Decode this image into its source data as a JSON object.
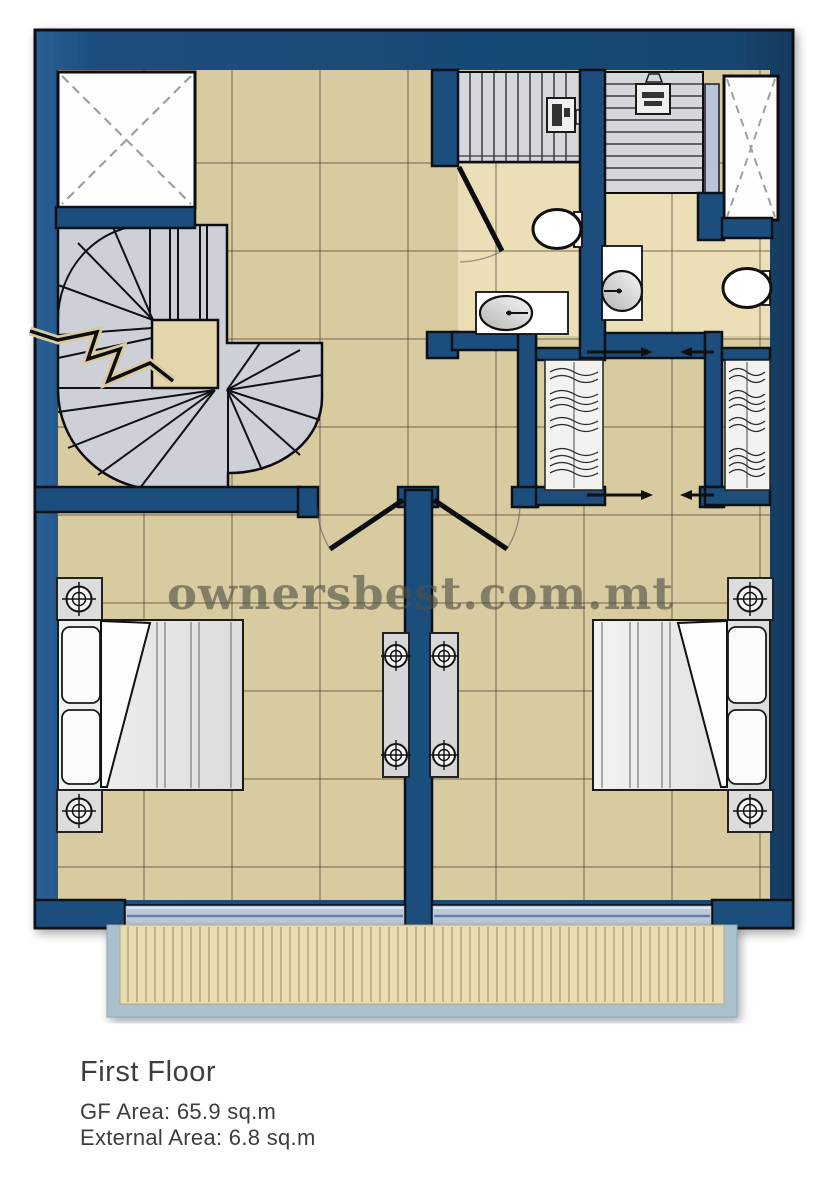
{
  "watermark": {
    "text": "ownersbest.com.mt"
  },
  "caption": {
    "title": "First Floor",
    "gf_area": "GF Area: 65.9 sq.m",
    "external_area": "External Area: 6.8 sq.m"
  },
  "colors": {
    "wall_navy": "#1c4e7d",
    "wall_outline": "#0c1118",
    "floor_tan": "#d9cba0",
    "bathroom_floor": "#ecdfb8",
    "stair_gray": "#d3d4da",
    "fixture_white": "#ffffff",
    "balcony_rail": "#abc0cd",
    "deck_tan": "#e8dcb1",
    "glass_blue": "#bdc9db",
    "watermark_gray": "#514f46",
    "caption_gray": "#3d3d3d"
  },
  "fixtures": [
    "void-shaft",
    "spiral-staircase",
    "stair-break-line",
    "staircase-up",
    "water-heater",
    "toilet",
    "wash-basin",
    "vanity-unit",
    "wardrobe-hanging-rail",
    "sliding-door-arrow",
    "double-door",
    "bathroom-door",
    "double-bed",
    "pillow",
    "nightstand",
    "ceiling-lamp",
    "bedside-console",
    "sliding-glass-door",
    "balcony-decking",
    "balcony-railing"
  ]
}
